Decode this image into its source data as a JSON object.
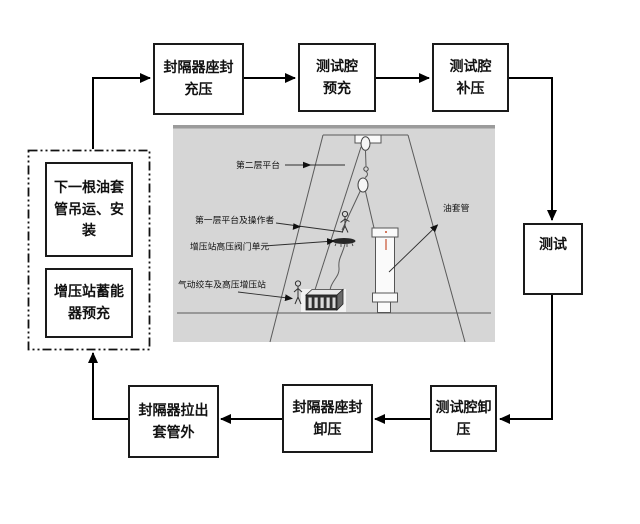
{
  "flow": {
    "top_row": [
      {
        "id": "packer-set-pressurize",
        "label": "封隔器座封\n充压"
      },
      {
        "id": "test-chamber-prefill",
        "label": "测试腔\n预充"
      },
      {
        "id": "test-chamber-supplement",
        "label": "测试腔\n补压"
      }
    ],
    "right_box": {
      "id": "test",
      "label": "测试"
    },
    "bottom_row": [
      {
        "id": "test-chamber-release",
        "label": "测试腔卸\n压"
      },
      {
        "id": "packer-set-release",
        "label": "封隔器座封\n卸压"
      },
      {
        "id": "packer-pull-out",
        "label": "封隔器拉出\n套管外"
      }
    ],
    "dashed_group": [
      {
        "id": "next-casing-hoist-install",
        "label": "下一根油套\n管吊运、安\n装"
      },
      {
        "id": "booster-accumulator-prefill",
        "label": "增压站蓄能\n器预充"
      }
    ]
  },
  "illustration": {
    "labels": {
      "second_platform": "第二层平台",
      "first_platform_operator": "第一层平台及操作者",
      "valve_unit": "增压站高压阀门单元",
      "winch_booster": "气动绞车及高压增压站",
      "oil_casing": "油套管"
    }
  },
  "colors": {
    "box_border": "#1a1a1a",
    "arrow": "#000000",
    "illustration_bg": "#d6d6d6",
    "illustration_top_edge": "#9b9b9b",
    "structure_line": "#5a5a5a",
    "red_mark": "#c8502e"
  }
}
